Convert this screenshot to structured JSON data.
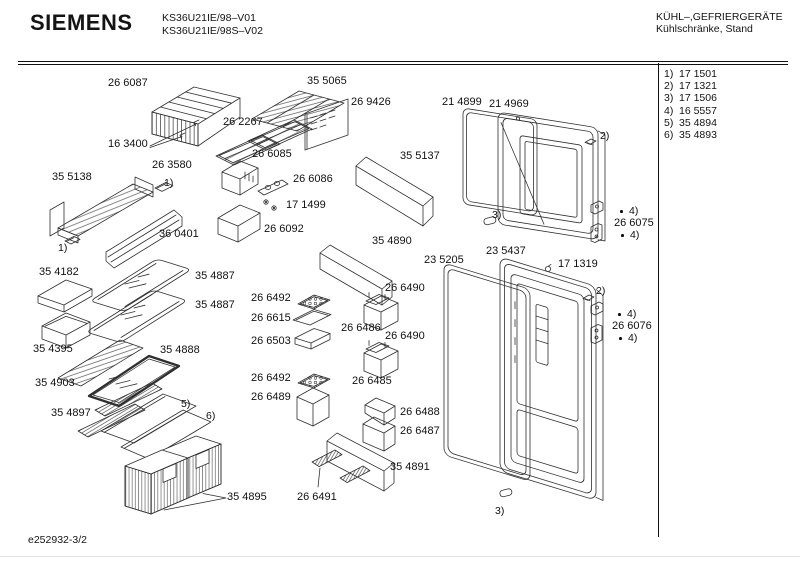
{
  "header": {
    "brand": "SIEMENS",
    "model_line1": "KS36U21IE/98–V01",
    "model_line2": "KS36U21IE/98S–V02",
    "category_line1": "KÜHL–,GEFRIERGERÄTE",
    "category_line2": "Kühlschränke, Stand"
  },
  "legend": {
    "items": [
      {
        "ref": "1)",
        "number": "17 1501"
      },
      {
        "ref": "2)",
        "number": "17 1321"
      },
      {
        "ref": "3)",
        "number": "17 1506"
      },
      {
        "ref": "4)",
        "number": "16 5557"
      },
      {
        "ref": "5)",
        "number": "35 4894"
      },
      {
        "ref": "6)",
        "number": "35 4893"
      }
    ]
  },
  "footer": {
    "doc_number": "e252932-3/2"
  },
  "diagram": {
    "part_labels": [
      {
        "text": "26 6087",
        "x": 108,
        "y": 77
      },
      {
        "text": "35 5065",
        "x": 307,
        "y": 75
      },
      {
        "text": "26 9426",
        "x": 351,
        "y": 96
      },
      {
        "text": "21 4899",
        "x": 442,
        "y": 96
      },
      {
        "text": "21 4969",
        "x": 489,
        "y": 98
      },
      {
        "text": "26 2267",
        "x": 223,
        "y": 116
      },
      {
        "text": "16 3400",
        "x": 108,
        "y": 138
      },
      {
        "text": "26 6085",
        "x": 252,
        "y": 148
      },
      {
        "text": "35 5137",
        "x": 400,
        "y": 150
      },
      {
        "text": "26 3580",
        "x": 152,
        "y": 159
      },
      {
        "text": "35 5138",
        "x": 52,
        "y": 171
      },
      {
        "text": "26 6086",
        "x": 293,
        "y": 173
      },
      {
        "text": "17 1499",
        "x": 286,
        "y": 199
      },
      {
        "text": "26 6075",
        "x": 614,
        "y": 217
      },
      {
        "text": "36 0401",
        "x": 159,
        "y": 228
      },
      {
        "text": "26 6092",
        "x": 264,
        "y": 223
      },
      {
        "text": "35 4890",
        "x": 372,
        "y": 235
      },
      {
        "text": "23 5437",
        "x": 486,
        "y": 245
      },
      {
        "text": "23 5205",
        "x": 424,
        "y": 254
      },
      {
        "text": "17 1319",
        "x": 558,
        "y": 258
      },
      {
        "text": "35 4182",
        "x": 39,
        "y": 266
      },
      {
        "text": "35 4887",
        "x": 195,
        "y": 270
      },
      {
        "text": "26 6490",
        "x": 385,
        "y": 282
      },
      {
        "text": "26 6492",
        "x": 251,
        "y": 292
      },
      {
        "text": "35 4887",
        "x": 195,
        "y": 299
      },
      {
        "text": "26 6615",
        "x": 251,
        "y": 312
      },
      {
        "text": "26 6486",
        "x": 341,
        "y": 322
      },
      {
        "text": "26 6076",
        "x": 612,
        "y": 320
      },
      {
        "text": "26 6503",
        "x": 251,
        "y": 335
      },
      {
        "text": "26 6490",
        "x": 385,
        "y": 330
      },
      {
        "text": "35 4395",
        "x": 33,
        "y": 343
      },
      {
        "text": "35 4888",
        "x": 160,
        "y": 344
      },
      {
        "text": "26 6492",
        "x": 251,
        "y": 372
      },
      {
        "text": "35 4903",
        "x": 35,
        "y": 377
      },
      {
        "text": "26 6485",
        "x": 352,
        "y": 375
      },
      {
        "text": "26 6489",
        "x": 251,
        "y": 391
      },
      {
        "text": "26 6488",
        "x": 400,
        "y": 406
      },
      {
        "text": "35 4897",
        "x": 51,
        "y": 407
      },
      {
        "text": "26 6487",
        "x": 400,
        "y": 425
      },
      {
        "text": "35 4891",
        "x": 390,
        "y": 461
      },
      {
        "text": "35 4895",
        "x": 227,
        "y": 491
      },
      {
        "text": "26 6491",
        "x": 297,
        "y": 491
      }
    ],
    "ref_markers": [
      {
        "text": "1)",
        "x": 164,
        "y": 177
      },
      {
        "text": "1)",
        "x": 58,
        "y": 242
      },
      {
        "text": "2)",
        "x": 600,
        "y": 130
      },
      {
        "text": "3)",
        "x": 492,
        "y": 209
      },
      {
        "text": "4)",
        "x": 629,
        "y": 205,
        "bullet": true
      },
      {
        "text": "4)",
        "x": 630,
        "y": 229,
        "bullet": true
      },
      {
        "text": "2)",
        "x": 596,
        "y": 285
      },
      {
        "text": "4)",
        "x": 627,
        "y": 308,
        "bullet": true
      },
      {
        "text": "4)",
        "x": 628,
        "y": 332,
        "bullet": true
      },
      {
        "text": "3)",
        "x": 495,
        "y": 505
      },
      {
        "text": "5)",
        "x": 181,
        "y": 398
      },
      {
        "text": "6)",
        "x": 206,
        "y": 410
      }
    ]
  }
}
